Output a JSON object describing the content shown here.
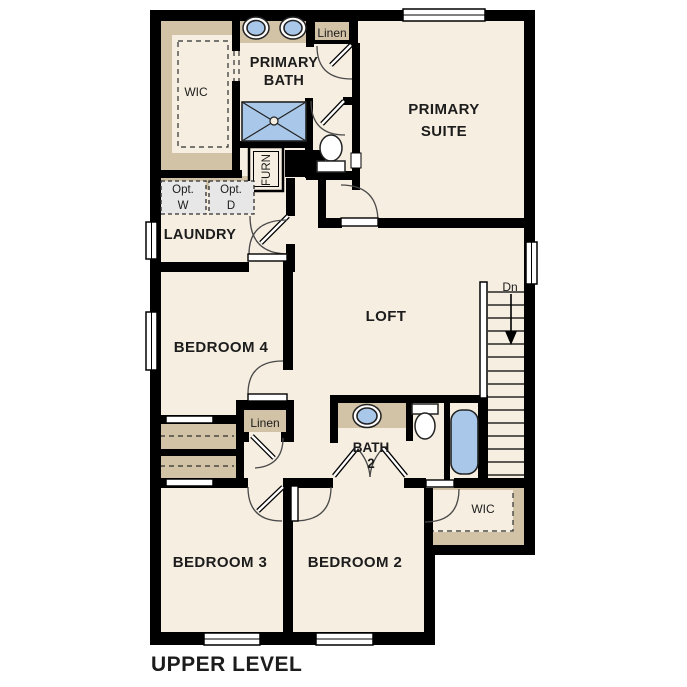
{
  "plan_name": "UPPER LEVEL",
  "colors": {
    "floor": "#f6eee1",
    "closet_tan": "#d2c3a6",
    "fixture_blue": "#a9c8e9",
    "wall": "#000000",
    "appliance_gray": "#e7e7e7",
    "door_line": "#4a4a4a",
    "text_dark": "#1c1c1c",
    "window_white": "#ffffff"
  },
  "rooms": {
    "primary_suite": {
      "line1": "PRIMARY",
      "line2": "SUITE"
    },
    "primary_bath": {
      "line1": "PRIMARY",
      "line2": "BATH"
    },
    "primary_wic": {
      "label": "WIC"
    },
    "linen_upper": {
      "label": "Linen"
    },
    "laundry": {
      "label": "LAUNDRY"
    },
    "furnace": {
      "label": "FURN"
    },
    "opt_washer": {
      "line1": "Opt.",
      "line2": "W"
    },
    "opt_dryer": {
      "line1": "Opt.",
      "line2": "D"
    },
    "bedroom4": {
      "label": "BEDROOM 4"
    },
    "loft": {
      "label": "LOFT"
    },
    "stairs": {
      "direction_label": "Dn"
    },
    "linen_hall": {
      "label": "Linen"
    },
    "bath2": {
      "line1": "BATH",
      "line2": "2"
    },
    "wic2": {
      "label": "WIC"
    },
    "bedroom3": {
      "label": "BEDROOM 3"
    },
    "bedroom2": {
      "label": "BEDROOM 2"
    }
  },
  "footer": {
    "label": "UPPER LEVEL"
  }
}
